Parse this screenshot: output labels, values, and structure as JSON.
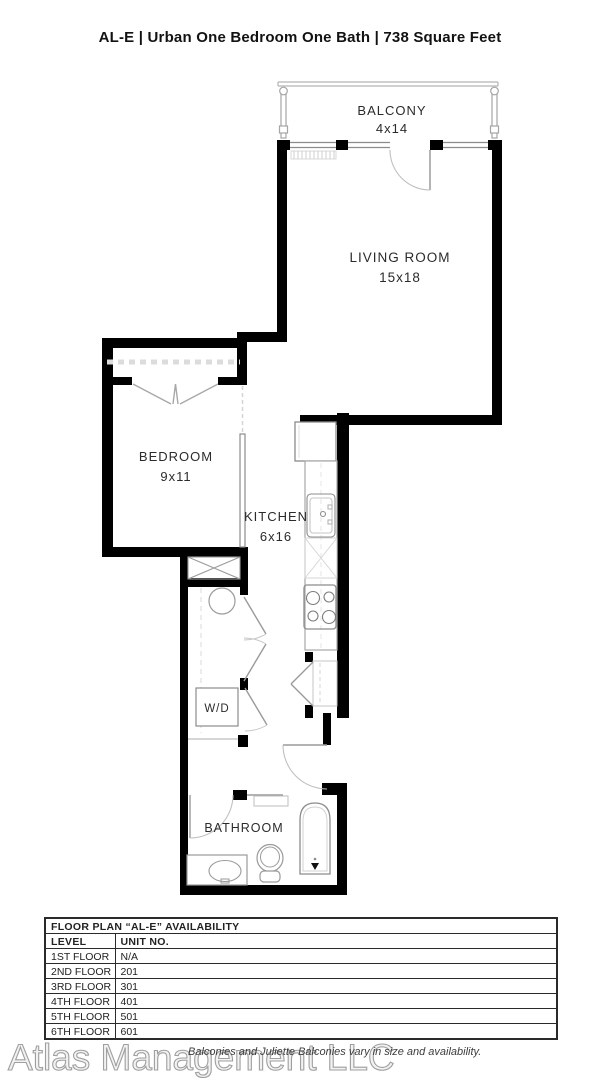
{
  "title": "AL-E | Urban One Bedroom One Bath | 738 Square Feet",
  "plan": {
    "balcony_label": "BALCONY",
    "balcony_dims": "4x14",
    "living_label": "LIVING ROOM",
    "living_dims": "15x18",
    "bedroom_label": "BEDROOM",
    "bedroom_dims": "9x11",
    "kitchen_label": "KITCHEN",
    "kitchen_dims": "6x16",
    "wd_label": "W/D",
    "bathroom_label": "BATHROOM"
  },
  "availability": {
    "title": "FLOOR PLAN “AL-E” AVAILABILITY",
    "columns": [
      "LEVEL",
      "UNIT NO."
    ],
    "rows": [
      [
        "1ST FLOOR",
        "N/A"
      ],
      [
        "2ND FLOOR",
        "201"
      ],
      [
        "3RD FLOOR",
        "301"
      ],
      [
        "4TH FLOOR",
        "401"
      ],
      [
        "5TH FLOOR",
        "501"
      ],
      [
        "6TH FLOOR",
        "601"
      ]
    ]
  },
  "footer": {
    "watermark": "Atlas Management LLC",
    "disclaimer": "Balconies and Juliette Balconies vary in size and availability."
  },
  "colors": {
    "wall": "#000000",
    "fixture": "#8a8a8a",
    "light_line": "#c4c4c4",
    "text": "#2b2b2b"
  }
}
